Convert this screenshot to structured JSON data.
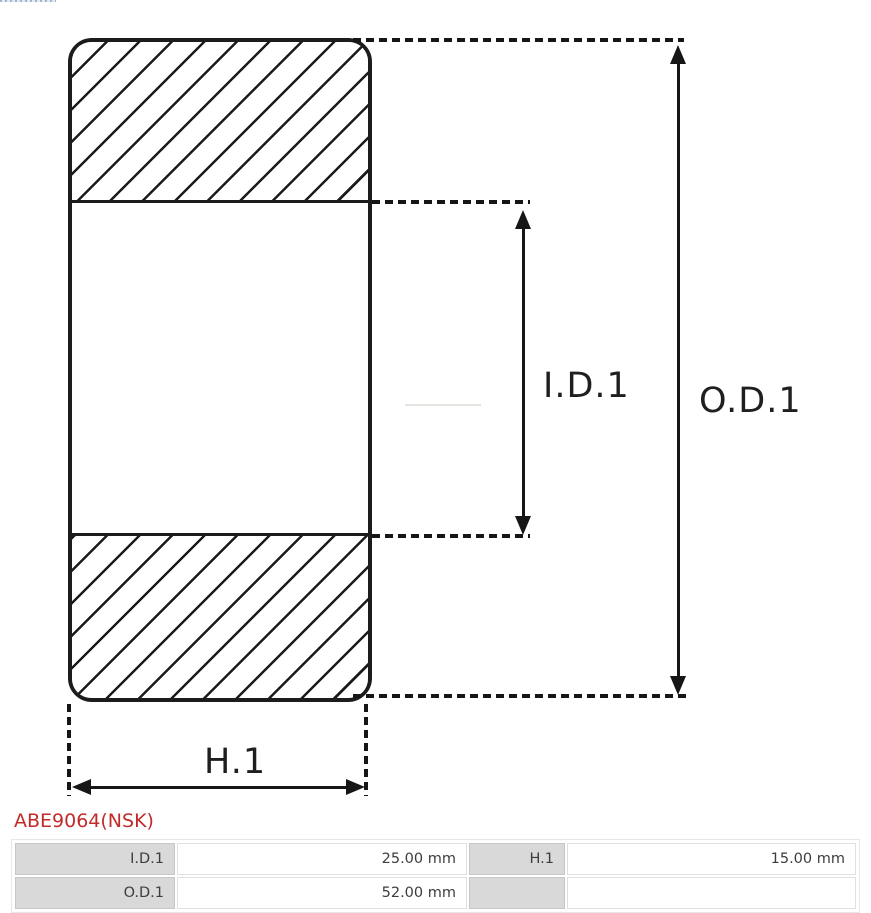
{
  "colors": {
    "line": "#1c1c1c",
    "accent_red": "#c32b2b",
    "table_header_bg": "#d9d9d9"
  },
  "diagram": {
    "dimension_labels": {
      "inner_diameter": "I.D.1",
      "outer_diameter": "O.D.1",
      "width": "H.1"
    }
  },
  "part": {
    "code": "ABE9064(NSK)"
  },
  "spec_table": {
    "rows": [
      {
        "c0": "I.D.1",
        "c1": "25.00 mm",
        "c2": "H.1",
        "c3": "15.00 mm"
      },
      {
        "c0": "O.D.1",
        "c1": "52.00 mm",
        "c2": "",
        "c3": ""
      }
    ]
  }
}
